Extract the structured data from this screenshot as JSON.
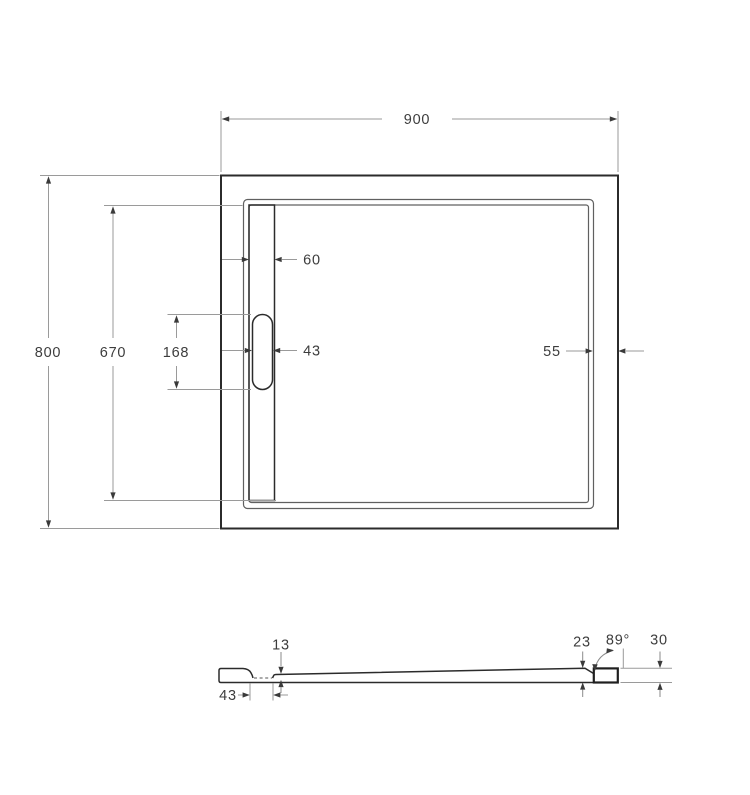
{
  "top_view": {
    "overall_width": "900",
    "overall_depth": "800",
    "channel_length": "670",
    "drain_cover_length": "168",
    "drain_cover_width": "43",
    "channel_width": "60",
    "right_rim_width": "55"
  },
  "section_view": {
    "floor_step_depth": "13",
    "drain_slot_width": "43",
    "end_thickness": "23",
    "wall_angle": "89°",
    "total_height": "30"
  },
  "colors": {
    "outline": "#2b2b2b",
    "dimension_lines": "#9a9a9a",
    "label_text": "#3d3d3d",
    "background": "#ffffff"
  }
}
